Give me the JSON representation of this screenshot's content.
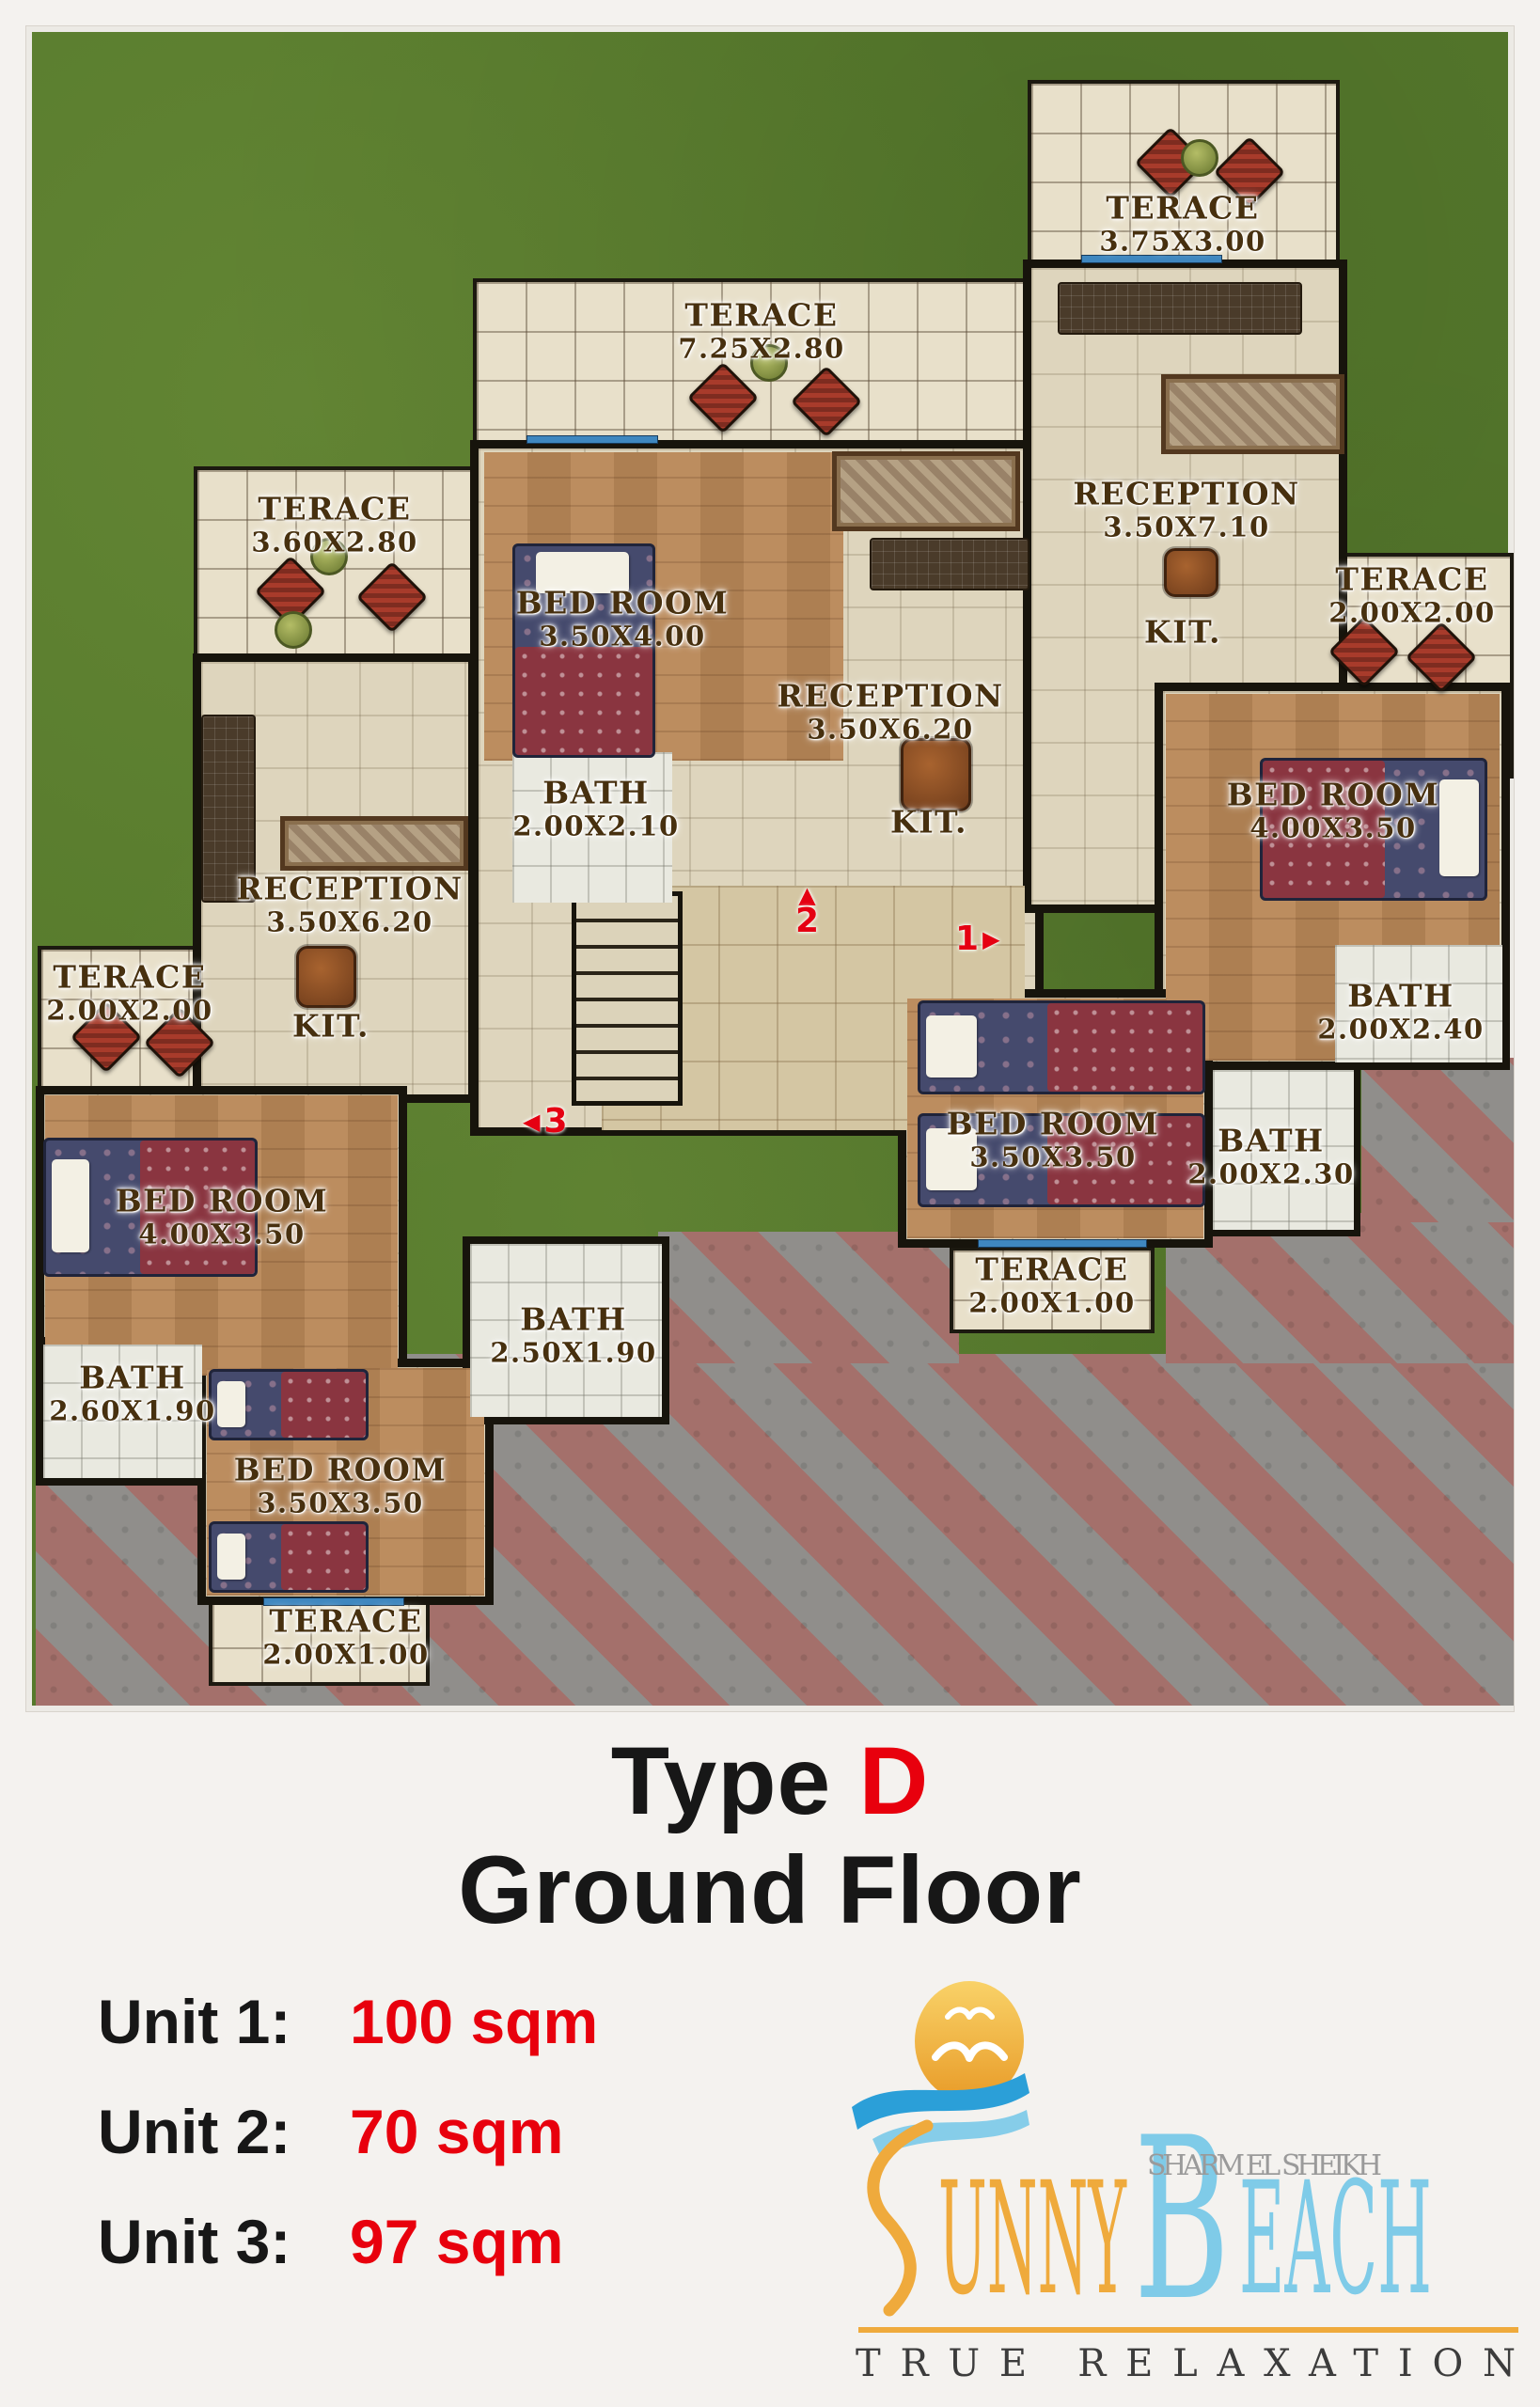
{
  "colors": {
    "grass": "#567a2c",
    "floor_beige": "#ded5bd",
    "terrace_beige": "#e8e0ca",
    "wall_black": "#17140c",
    "pave_red": "#a4706b",
    "pave_gray": "#908e8b",
    "label_brown": "#47300f",
    "accent_red": "#e8000d",
    "logo_orange": "#efaa3c",
    "logo_blue": "#7fcbe8",
    "logo_wave_blue": "#2b9fd8",
    "logo_gray": "#9a9a9a"
  },
  "plan": {
    "rooms": [
      {
        "name": "TERACE",
        "dims": "3.75X3.00"
      },
      {
        "name": "TERACE",
        "dims": "7.25X2.80"
      },
      {
        "name": "TERACE",
        "dims": "3.60X2.80"
      },
      {
        "name": "BED ROOM",
        "dims": "3.50X4.00"
      },
      {
        "name": "RECEPTION",
        "dims": "3.50X7.10"
      },
      {
        "name": "KIT.",
        "dims": ""
      },
      {
        "name": "RECEPTION",
        "dims": "3.50X6.20"
      },
      {
        "name": "KIT.",
        "dims": ""
      },
      {
        "name": "TERACE",
        "dims": "2.00X2.00"
      },
      {
        "name": "BED ROOM",
        "dims": "4.00X3.50"
      },
      {
        "name": "BATH",
        "dims": "2.00X2.10"
      },
      {
        "name": "BATH",
        "dims": "2.00X2.40"
      },
      {
        "name": "BATH",
        "dims": "2.00X2.30"
      },
      {
        "name": "RECEPTION",
        "dims": "3.50X6.20"
      },
      {
        "name": "KIT.",
        "dims": ""
      },
      {
        "name": "TERACE",
        "dims": "2.00X2.00"
      },
      {
        "name": "BED ROOM",
        "dims": "4.00X3.50"
      },
      {
        "name": "BED ROOM",
        "dims": "3.50X3.50"
      },
      {
        "name": "TERACE",
        "dims": "2.00X1.00"
      },
      {
        "name": "BATH",
        "dims": "2.50X1.90"
      },
      {
        "name": "BATH",
        "dims": "2.60X1.90"
      },
      {
        "name": "BED ROOM",
        "dims": "3.50X3.50"
      },
      {
        "name": "TERACE",
        "dims": "2.00X1.00"
      }
    ],
    "markers": [
      {
        "num": "2",
        "arrow": "▲"
      },
      {
        "num": "1",
        "arrow": "▶"
      },
      {
        "num": "3",
        "arrow": "◀"
      }
    ]
  },
  "title": {
    "black": "Type",
    "red": "D",
    "line2": "Ground Floor"
  },
  "units": [
    {
      "label": "Unit 1:",
      "value": "100 sqm"
    },
    {
      "label": "Unit 2:",
      "value": "70 sqm"
    },
    {
      "label": "Unit 3:",
      "value": "97 sqm"
    }
  ],
  "logo": {
    "sunny_initial": "S",
    "sunny_rest": "UNNY",
    "beach_initial": "B",
    "beach_rest": "EACH",
    "location": "SHARM EL SHEIKH",
    "tagline": "TRUE RELAXATION"
  }
}
